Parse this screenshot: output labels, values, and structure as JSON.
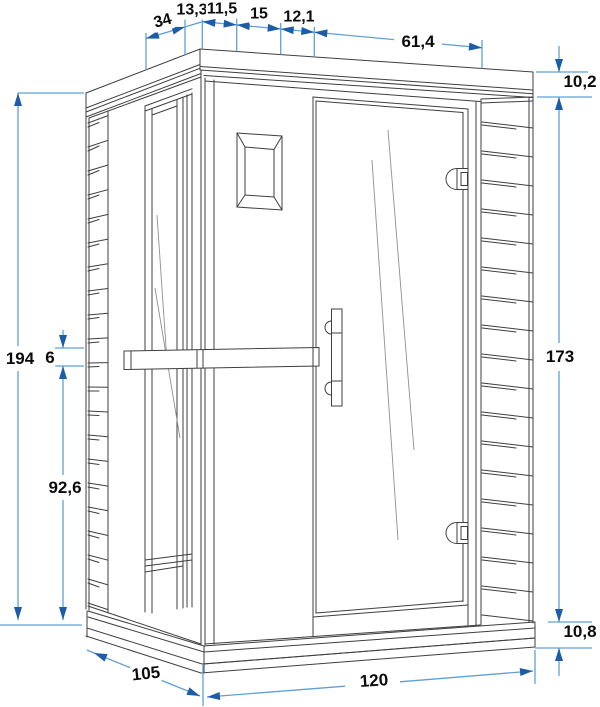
{
  "colors": {
    "background": "#ffffff",
    "line_art": "#3f3f3f",
    "glass_line": "#8f8f8f",
    "dim_line": "#5FA0D6",
    "dim_arrow": "#1D5CA9",
    "dim_text": "#0b0b0b"
  },
  "dims": {
    "top": [
      "34",
      "13,3",
      "11,5",
      "15",
      "12,1",
      "61,4"
    ],
    "right": [
      "10,2",
      "173",
      "10,8"
    ],
    "left": [
      "194",
      "6",
      "92,6"
    ],
    "bottom": [
      "105",
      "120"
    ]
  }
}
